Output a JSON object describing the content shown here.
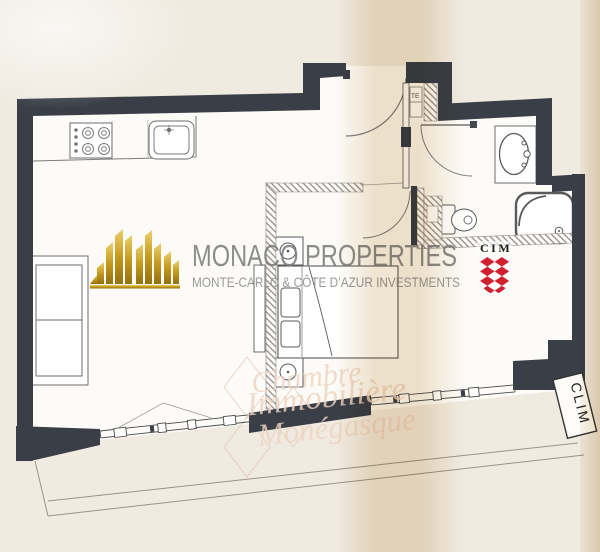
{
  "branding": {
    "title": "MONACO PROPERTIES",
    "subtitle": "MONTE-CARLO & CÔTE D’AZUR INVESTMENTS",
    "title_color": "#7c7c7c",
    "subtitle_color": "#8f8f8f",
    "gold": "#c59a1e"
  },
  "cim_logo": {
    "label": "CIM",
    "shield_red": "#d01f2f"
  },
  "watermark": {
    "line1": "Chambre",
    "line2": "Immobilière",
    "line3": "Monégasque"
  },
  "plan_labels": {
    "ac_unit": "CLIM",
    "utility_closet": "TE"
  },
  "palette": {
    "wall": "#3a3e46",
    "paper": "#f0ebe1",
    "floor": "#fcfbf7",
    "line": "#666666"
  }
}
